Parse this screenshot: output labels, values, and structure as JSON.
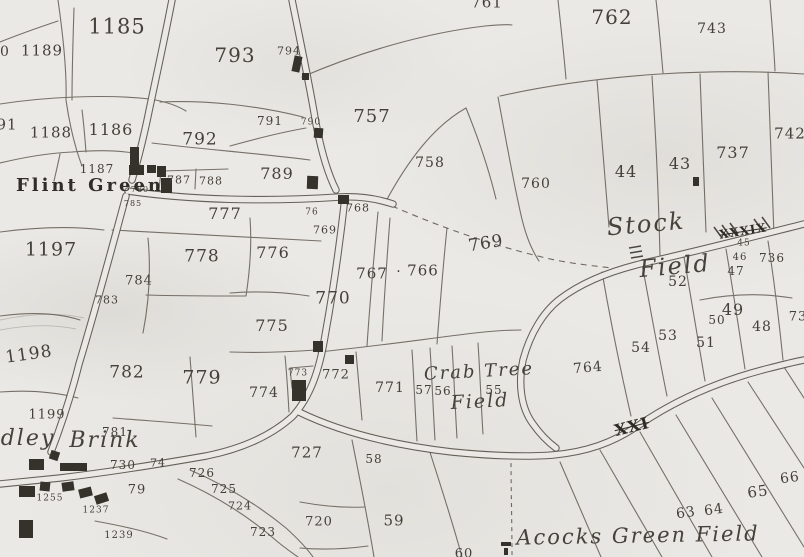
{
  "map": {
    "title": "historic parcel survey map - Flint Green / Stock Field / Acocks Green",
    "paper_color": "#eae9e5",
    "ink_color": "#57524a",
    "building_color": "#35312b",
    "place_labels": [
      {
        "text": "Flint Green",
        "x": 90,
        "y": 186,
        "size": 18,
        "style": "place-bold",
        "rot": 0
      },
      {
        "text": "Stock",
        "x": 646,
        "y": 224,
        "size": 24,
        "style": "script",
        "rot": -5
      },
      {
        "text": "Field",
        "x": 675,
        "y": 266,
        "size": 24,
        "style": "script",
        "rot": -5
      },
      {
        "text": "Crab Tree",
        "x": 479,
        "y": 372,
        "size": 18,
        "style": "script",
        "rot": -3
      },
      {
        "text": "Field",
        "x": 480,
        "y": 402,
        "size": 19,
        "style": "script",
        "rot": -3
      },
      {
        "text": "Acocks Green Field",
        "x": 638,
        "y": 536,
        "size": 21,
        "style": "script",
        "rot": -1
      },
      {
        "text": "dley",
        "x": 28,
        "y": 439,
        "size": 22,
        "style": "script",
        "rot": 0
      },
      {
        "text": "Brink",
        "x": 105,
        "y": 441,
        "size": 22,
        "style": "script",
        "rot": 0
      }
    ],
    "road_numerals": [
      {
        "text": "XXI",
        "x": 632,
        "y": 427,
        "size": 16,
        "rot": -14
      },
      {
        "text": "XXXIX",
        "x": 743,
        "y": 231,
        "size": 12,
        "rot": -9
      }
    ],
    "parcel_numbers": [
      {
        "text": "1185",
        "x": 117,
        "y": 27,
        "size": 21
      },
      {
        "text": "1189",
        "x": 42,
        "y": 51,
        "size": 15
      },
      {
        "text": "0",
        "x": 5,
        "y": 52,
        "size": 14
      },
      {
        "text": "1186",
        "x": 111,
        "y": 130,
        "size": 16
      },
      {
        "text": "1188",
        "x": 51,
        "y": 133,
        "size": 15
      },
      {
        "text": "91",
        "x": 7,
        "y": 125,
        "size": 15
      },
      {
        "text": "1187",
        "x": 97,
        "y": 169,
        "size": 12
      },
      {
        "text": "1197",
        "x": 51,
        "y": 250,
        "size": 19
      },
      {
        "text": "1198",
        "x": 29,
        "y": 355,
        "size": 17,
        "rot": -8
      },
      {
        "text": "1199",
        "x": 47,
        "y": 415,
        "size": 13
      },
      {
        "text": "793",
        "x": 235,
        "y": 55,
        "size": 20
      },
      {
        "text": "792",
        "x": 200,
        "y": 140,
        "size": 17
      },
      {
        "text": "794",
        "x": 289,
        "y": 51,
        "size": 11
      },
      {
        "text": "791",
        "x": 270,
        "y": 121,
        "size": 12
      },
      {
        "text": "790",
        "x": 311,
        "y": 123,
        "size": 9
      },
      {
        "text": "789",
        "x": 277,
        "y": 174,
        "size": 16
      },
      {
        "text": "787",
        "x": 179,
        "y": 180,
        "size": 11
      },
      {
        "text": "788",
        "x": 211,
        "y": 181,
        "size": 11
      },
      {
        "text": "757",
        "x": 372,
        "y": 117,
        "size": 18
      },
      {
        "text": "758",
        "x": 430,
        "y": 163,
        "size": 14
      },
      {
        "text": "761",
        "x": 487,
        "y": 3,
        "size": 15
      },
      {
        "text": "762",
        "x": 612,
        "y": 17,
        "size": 20
      },
      {
        "text": "743",
        "x": 712,
        "y": 29,
        "size": 14
      },
      {
        "text": "737",
        "x": 733,
        "y": 153,
        "size": 16
      },
      {
        "text": "742",
        "x": 790,
        "y": 134,
        "size": 15
      },
      {
        "text": "44",
        "x": 626,
        "y": 172,
        "size": 16
      },
      {
        "text": "43",
        "x": 680,
        "y": 164,
        "size": 16
      },
      {
        "text": "760",
        "x": 536,
        "y": 184,
        "size": 14
      },
      {
        "text": "769",
        "x": 486,
        "y": 244,
        "size": 17,
        "rot": -9
      },
      {
        "text": "777",
        "x": 225,
        "y": 214,
        "size": 16
      },
      {
        "text": "778",
        "x": 202,
        "y": 257,
        "size": 17
      },
      {
        "text": "776",
        "x": 273,
        "y": 253,
        "size": 16
      },
      {
        "text": "775",
        "x": 272,
        "y": 326,
        "size": 16
      },
      {
        "text": "770",
        "x": 333,
        "y": 299,
        "size": 17
      },
      {
        "text": "767",
        "x": 372,
        "y": 274,
        "size": 15
      },
      {
        "text": ".",
        "x": 399,
        "y": 268,
        "size": 14
      },
      {
        "text": "766",
        "x": 423,
        "y": 271,
        "size": 15
      },
      {
        "text": "768",
        "x": 358,
        "y": 208,
        "size": 11
      },
      {
        "text": "769",
        "x": 325,
        "y": 230,
        "size": 11
      },
      {
        "text": "76",
        "x": 312,
        "y": 213,
        "size": 9
      },
      {
        "text": "784",
        "x": 139,
        "y": 281,
        "size": 13
      },
      {
        "text": "783",
        "x": 107,
        "y": 300,
        "size": 11
      },
      {
        "text": "780",
        "x": 140,
        "y": 190,
        "size": 8
      },
      {
        "text": "785",
        "x": 133,
        "y": 204,
        "size": 8
      },
      {
        "text": "782",
        "x": 127,
        "y": 373,
        "size": 17
      },
      {
        "text": "779",
        "x": 202,
        "y": 378,
        "size": 19
      },
      {
        "text": "781",
        "x": 115,
        "y": 432,
        "size": 12
      },
      {
        "text": "730",
        "x": 123,
        "y": 465,
        "size": 12
      },
      {
        "text": "74",
        "x": 158,
        "y": 463,
        "size": 11
      },
      {
        "text": "79",
        "x": 137,
        "y": 490,
        "size": 13
      },
      {
        "text": "727",
        "x": 307,
        "y": 453,
        "size": 15
      },
      {
        "text": "726",
        "x": 202,
        "y": 473,
        "size": 12
      },
      {
        "text": "725",
        "x": 224,
        "y": 489,
        "size": 12
      },
      {
        "text": "724",
        "x": 240,
        "y": 506,
        "size": 11
      },
      {
        "text": "723",
        "x": 263,
        "y": 532,
        "size": 12
      },
      {
        "text": "720",
        "x": 319,
        "y": 522,
        "size": 13
      },
      {
        "text": "1255",
        "x": 50,
        "y": 499,
        "size": 9
      },
      {
        "text": "1237",
        "x": 96,
        "y": 511,
        "size": 9
      },
      {
        "text": "1239",
        "x": 119,
        "y": 536,
        "size": 10
      },
      {
        "text": "773",
        "x": 298,
        "y": 374,
        "size": 9
      },
      {
        "text": "772",
        "x": 336,
        "y": 375,
        "size": 13
      },
      {
        "text": "774",
        "x": 264,
        "y": 393,
        "size": 14
      },
      {
        "text": "771",
        "x": 390,
        "y": 388,
        "size": 14
      },
      {
        "text": "57",
        "x": 424,
        "y": 390,
        "size": 12
      },
      {
        "text": "56",
        "x": 443,
        "y": 391,
        "size": 12
      },
      {
        "text": "55",
        "x": 494,
        "y": 390,
        "size": 12
      },
      {
        "text": "58",
        "x": 374,
        "y": 459,
        "size": 12
      },
      {
        "text": "59",
        "x": 394,
        "y": 521,
        "size": 15
      },
      {
        "text": "60",
        "x": 464,
        "y": 554,
        "size": 13
      },
      {
        "text": "764",
        "x": 588,
        "y": 368,
        "size": 14,
        "rot": -5
      },
      {
        "text": "52",
        "x": 678,
        "y": 282,
        "size": 14
      },
      {
        "text": "53",
        "x": 668,
        "y": 336,
        "size": 14
      },
      {
        "text": "54",
        "x": 641,
        "y": 348,
        "size": 14
      },
      {
        "text": "51",
        "x": 706,
        "y": 343,
        "size": 14
      },
      {
        "text": "49",
        "x": 733,
        "y": 310,
        "size": 16
      },
      {
        "text": "50",
        "x": 717,
        "y": 320,
        "size": 12
      },
      {
        "text": "48",
        "x": 762,
        "y": 327,
        "size": 14
      },
      {
        "text": "45",
        "x": 744,
        "y": 244,
        "size": 9
      },
      {
        "text": "46",
        "x": 740,
        "y": 258,
        "size": 10
      },
      {
        "text": "47",
        "x": 736,
        "y": 271,
        "size": 12
      },
      {
        "text": "736",
        "x": 772,
        "y": 258,
        "size": 12
      },
      {
        "text": "73",
        "x": 798,
        "y": 317,
        "size": 13
      },
      {
        "text": "63",
        "x": 686,
        "y": 513,
        "size": 14,
        "rot": -8
      },
      {
        "text": "64",
        "x": 714,
        "y": 510,
        "size": 14,
        "rot": -8
      },
      {
        "text": "65",
        "x": 758,
        "y": 492,
        "size": 15,
        "rot": -8
      },
      {
        "text": "66",
        "x": 790,
        "y": 478,
        "size": 14,
        "rot": -8
      }
    ],
    "buildings": [
      {
        "x": 130,
        "y": 147,
        "w": 9,
        "h": 21,
        "rot": 0
      },
      {
        "x": 129,
        "y": 165,
        "w": 15,
        "h": 10,
        "rot": 0
      },
      {
        "x": 147,
        "y": 165,
        "w": 9,
        "h": 8,
        "rot": 0
      },
      {
        "x": 157,
        "y": 166,
        "w": 9,
        "h": 11,
        "rot": 0
      },
      {
        "x": 161,
        "y": 178,
        "w": 11,
        "h": 15,
        "rot": 0
      },
      {
        "x": 293,
        "y": 56,
        "w": 8,
        "h": 16,
        "rot": 12
      },
      {
        "x": 302,
        "y": 73,
        "w": 7,
        "h": 7,
        "rot": 0
      },
      {
        "x": 314,
        "y": 128,
        "w": 9,
        "h": 10,
        "rot": 4
      },
      {
        "x": 307,
        "y": 176,
        "w": 11,
        "h": 13,
        "rot": 2
      },
      {
        "x": 338,
        "y": 195,
        "w": 11,
        "h": 9,
        "rot": 0
      },
      {
        "x": 693,
        "y": 177,
        "w": 6,
        "h": 9,
        "rot": 0
      },
      {
        "x": 313,
        "y": 341,
        "w": 10,
        "h": 11,
        "rot": 0
      },
      {
        "x": 345,
        "y": 355,
        "w": 9,
        "h": 9,
        "rot": 0
      },
      {
        "x": 292,
        "y": 380,
        "w": 14,
        "h": 21,
        "rot": 0
      },
      {
        "x": 29,
        "y": 459,
        "w": 15,
        "h": 11,
        "rot": 0
      },
      {
        "x": 50,
        "y": 451,
        "w": 9,
        "h": 9,
        "rot": 18
      },
      {
        "x": 60,
        "y": 463,
        "w": 27,
        "h": 8,
        "rot": 0
      },
      {
        "x": 19,
        "y": 486,
        "w": 16,
        "h": 11,
        "rot": 0
      },
      {
        "x": 40,
        "y": 482,
        "w": 10,
        "h": 9,
        "rot": 6
      },
      {
        "x": 62,
        "y": 482,
        "w": 12,
        "h": 9,
        "rot": -8
      },
      {
        "x": 79,
        "y": 488,
        "w": 13,
        "h": 9,
        "rot": -14
      },
      {
        "x": 95,
        "y": 494,
        "w": 13,
        "h": 9,
        "rot": -18
      },
      {
        "x": 19,
        "y": 520,
        "w": 14,
        "h": 18,
        "rot": 0
      },
      {
        "x": 501,
        "y": 542,
        "w": 10,
        "h": 4,
        "rot": 0
      },
      {
        "x": 504,
        "y": 548,
        "w": 4,
        "h": 7,
        "rot": 0
      }
    ]
  }
}
